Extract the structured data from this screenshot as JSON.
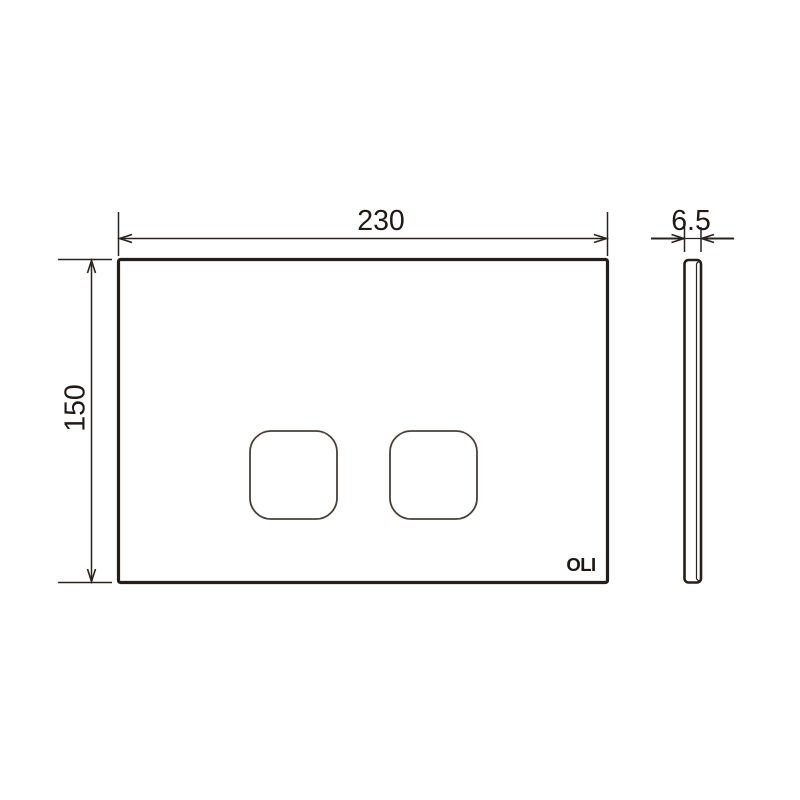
{
  "drawing": {
    "front_view": {
      "brand_label": "OLI"
    },
    "dimensions": {
      "width": {
        "label": "230"
      },
      "height": {
        "label": "150"
      },
      "thickness": {
        "label": "6.5"
      }
    },
    "colors": {
      "line": "#261e19",
      "dimension_line": "#2b231f",
      "text": "#211a15",
      "background": "#ffffff"
    }
  }
}
